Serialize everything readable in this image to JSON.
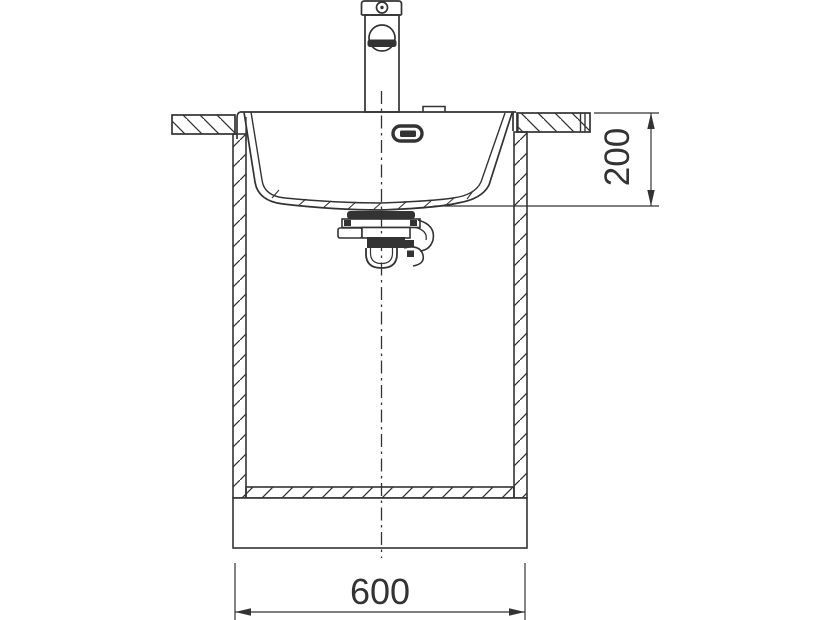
{
  "diagram": {
    "type": "technical-drawing",
    "subject": "kitchen-sink-front-section-with-cabinet",
    "line_color": "#333333",
    "background_color": "#ffffff",
    "dims": {
      "cabinet_width_label": "600",
      "bowl_depth_label": "200"
    },
    "parts": [
      "mixer-tap",
      "tap-hole-cover",
      "overflow-slot",
      "sink-bowl",
      "waste-drain-trap",
      "worktop-left",
      "worktop-right",
      "cabinet-side-left",
      "cabinet-side-right",
      "cabinet-bottom-panel",
      "cabinet-plinth",
      "vertical-centerline",
      "dimension-bowl-depth",
      "dimension-cabinet-width"
    ]
  }
}
